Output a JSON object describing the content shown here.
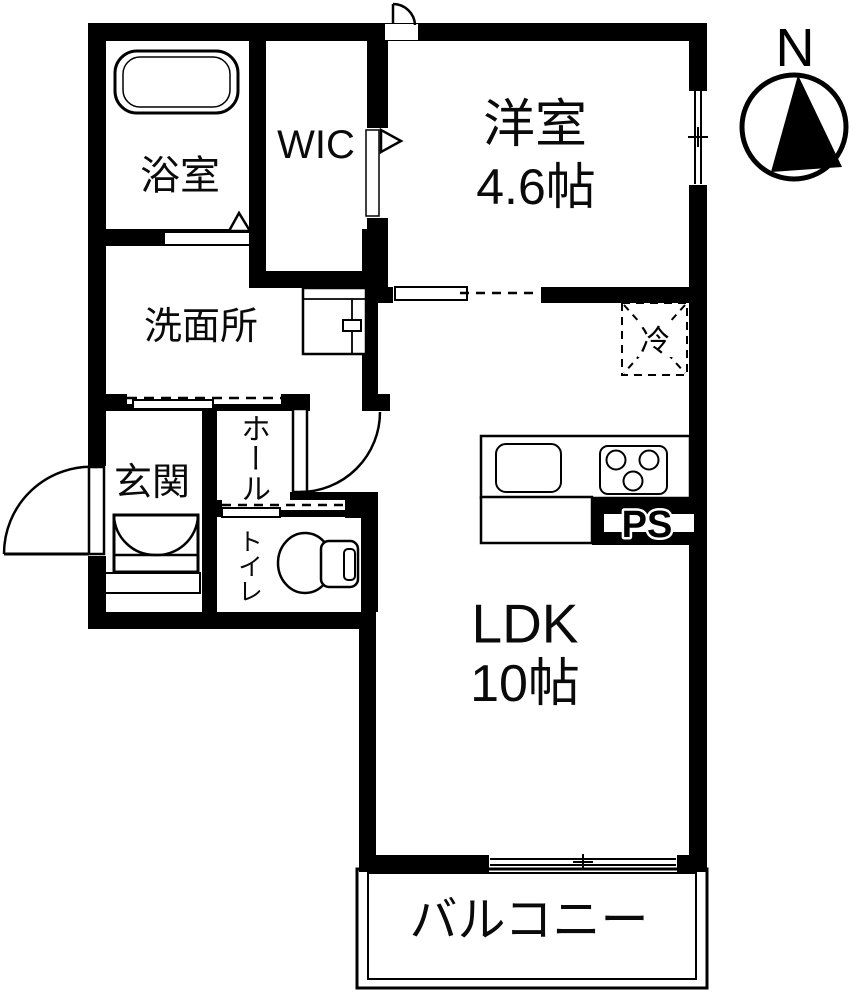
{
  "plan": {
    "rooms": {
      "bathroom": "浴室",
      "wic": "WIC",
      "western_room_name": "洋室",
      "western_room_size": "4.6帖",
      "washroom": "洗面所",
      "entrance": "玄関",
      "hall": "ホール",
      "toilet": "トイレ",
      "ldk_name": "LDK",
      "ldk_size": "10帖",
      "balcony": "バルコニー"
    },
    "labels": {
      "pipe_space": "PS",
      "refrigerator": "冷",
      "compass_north": "N"
    },
    "colors": {
      "wall": "#000000",
      "floor": "#ffffff"
    }
  }
}
